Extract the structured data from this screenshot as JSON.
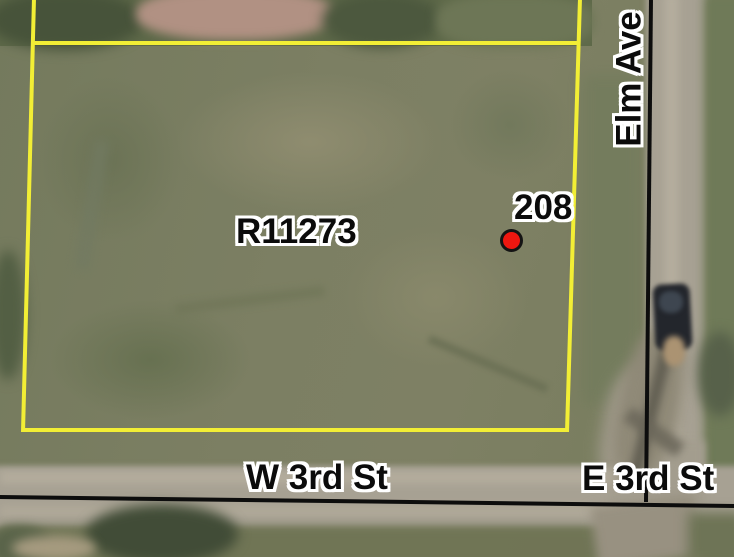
{
  "map": {
    "parcel": {
      "id_label": "R11273"
    },
    "marker": {
      "label": "208",
      "icon": "red-dot-icon"
    },
    "streets": {
      "vertical": {
        "name": "Elm Ave"
      },
      "bottom_west": {
        "name": "W 3rd St"
      },
      "bottom_east": {
        "name": "E 3rd St"
      }
    },
    "colors": {
      "parcel_outline": "#f2ee35",
      "road_line": "#0d0d0d",
      "marker_fill": "#ee1710",
      "marker_ring": "#141414",
      "label_text": "#0b0b0b",
      "label_halo": "#ffffff"
    }
  }
}
